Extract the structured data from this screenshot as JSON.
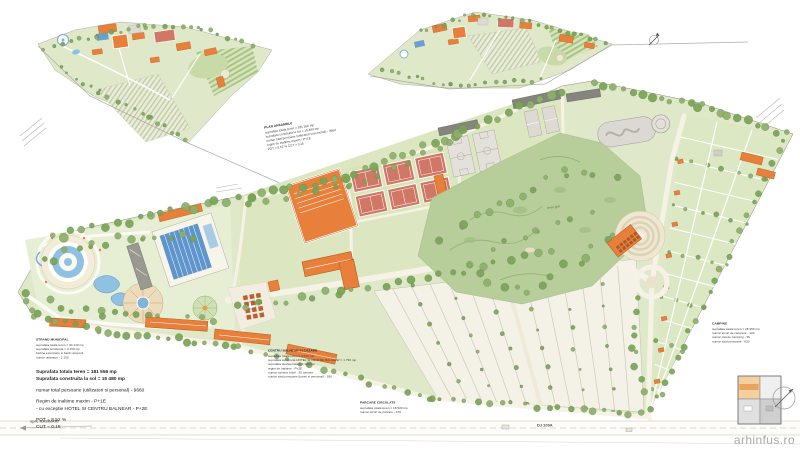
{
  "page": {
    "watermark": "arhinfus.ro"
  },
  "stats": {
    "line1": "Suprafata totala teren = 181 556 mp",
    "line2": "Suprafata construita la sol = 15 480 mp",
    "line3": "numar total persoane (utilizatori si personal) - 9660",
    "line4": "Regim de inaltime maxim - P+1E",
    "line5": "- cu exceptie HOTEL SI CENTRU BALNEAR - P+2E",
    "line6": "POT = 8.52 %",
    "line7": "CUT = 0.15"
  },
  "road": {
    "dj": "DJ 106A",
    "left": "spre RASINARI"
  },
  "labels": {
    "golf": "teren golf"
  },
  "annotations": {
    "plan_top": {
      "title": "PLAN ANSAMBLU",
      "lines": [
        "suprafata totala teren = 181 556 mp",
        "suprafata construita la sol = 15 480 mp",
        "numar total persoane (utilizatori si personal) - 9660",
        "regim de inaltime maxim - P+1E",
        "POT = 8.52 %   CUT = 0.15"
      ]
    },
    "strand": {
      "title": "STRAND MUNICIPAL",
      "lines": [
        "suprafata totala teren = 30 140 mp",
        "suprafata construita = 3 150 mp",
        "bazine exterioare si bazin acoperit",
        "numar utilizatori - 2 100"
      ]
    },
    "centru": {
      "title": "CENTRU BALNEAR SI CAZARE",
      "lines": [
        "suprafata totala teren = 4 570 mp",
        "suprafata construita HOTEL SI CENTRU BALNEAR = 1 730 mp",
        "suprafata desfasurata = 4 310 mp",
        "regim de inaltime - P+2E",
        "numar camere hotel - 30 camere",
        "numar total persoane (turisti si personal) - 180"
      ]
    },
    "parcare": {
      "title": "PARCARE CIRCULATII",
      "lines": [
        "suprafata totala teren = 18 520 mp",
        "numar locuri de parcare - 470"
      ]
    },
    "camping": {
      "title": "CAMPING",
      "lines": [
        "suprafata totala teren = 28 350 mp",
        "numar locuri de campare - 120",
        "numar casute camping - 36",
        "numar total persoane - 620"
      ]
    }
  },
  "colors": {
    "building_orange": "#e8803b",
    "court_red": "#d07765",
    "water_blue": "#6b9fd0",
    "tree_green": "#76a154",
    "site_green": "#dfe9ca",
    "road_cream": "#f6f2e6"
  }
}
